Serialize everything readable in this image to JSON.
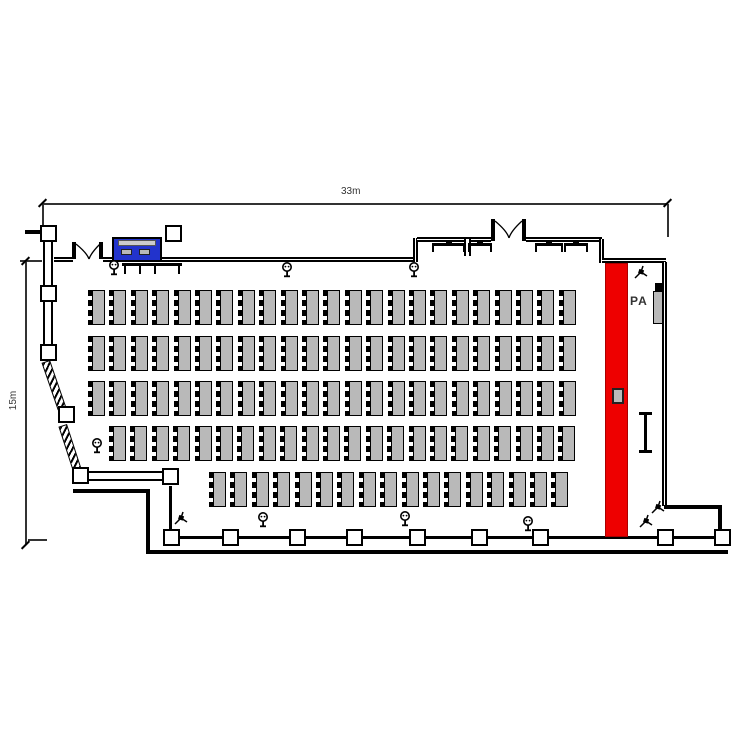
{
  "type": "venue-floor-plan",
  "dimensions": {
    "width_label": "33m",
    "height_label": "15m"
  },
  "labels": {
    "pa": "PA"
  },
  "colors": {
    "stage": "#ee0000",
    "av_desk": "#2233cc",
    "table": "#b9b9b9",
    "wall": "#000000",
    "background": "#ffffff"
  },
  "seating": {
    "unit": {
      "pitch": 21.4,
      "height": 35,
      "chair_strip_width": 4,
      "table_width": 13
    },
    "rows": [
      {
        "x": 88,
        "y": 290,
        "count": 23
      },
      {
        "x": 88,
        "y": 336,
        "count": 23
      },
      {
        "x": 88,
        "y": 381,
        "count": 23
      },
      {
        "x": 109,
        "y": 426,
        "count": 22
      },
      {
        "x": 209,
        "y": 472,
        "count": 17
      }
    ],
    "total_tables": 108
  },
  "stage": {
    "x": 605,
    "y": 263,
    "w": 23,
    "h": 274
  },
  "lectern": {
    "x": 612,
    "y": 388,
    "w": 12,
    "h": 16
  },
  "pa_speaker": {
    "x": 653,
    "y": 291,
    "w": 10,
    "h": 33
  },
  "av_desk": {
    "x": 112,
    "y": 237,
    "w": 50,
    "h": 25
  },
  "pillars": [
    [
      40,
      225
    ],
    [
      165,
      225
    ],
    [
      40,
      285
    ],
    [
      40,
      344
    ],
    [
      58,
      406
    ],
    [
      72,
      467
    ],
    [
      162,
      468
    ],
    [
      163,
      529
    ],
    [
      222,
      529
    ],
    [
      289,
      529
    ],
    [
      346,
      529
    ],
    [
      409,
      529
    ],
    [
      471,
      529
    ],
    [
      532,
      529
    ],
    [
      657,
      529
    ],
    [
      714,
      529
    ]
  ],
  "floor_sockets": [
    [
      108,
      260
    ],
    [
      281,
      262
    ],
    [
      408,
      262
    ],
    [
      91,
      438
    ],
    [
      257,
      512
    ],
    [
      399,
      511
    ],
    [
      522,
      516
    ]
  ],
  "tripods": [
    [
      633,
      265
    ],
    [
      173,
      511
    ],
    [
      638,
      514
    ],
    [
      650,
      500
    ]
  ],
  "wall_tables": [
    {
      "x": 432,
      "w": 33
    },
    {
      "x": 468,
      "w": 24
    },
    {
      "x": 535,
      "w": 28
    },
    {
      "x": 564,
      "w": 24
    }
  ],
  "icons": {
    "floor_socket": "floor-socket-icon",
    "tripod": "camera-tripod-icon"
  }
}
